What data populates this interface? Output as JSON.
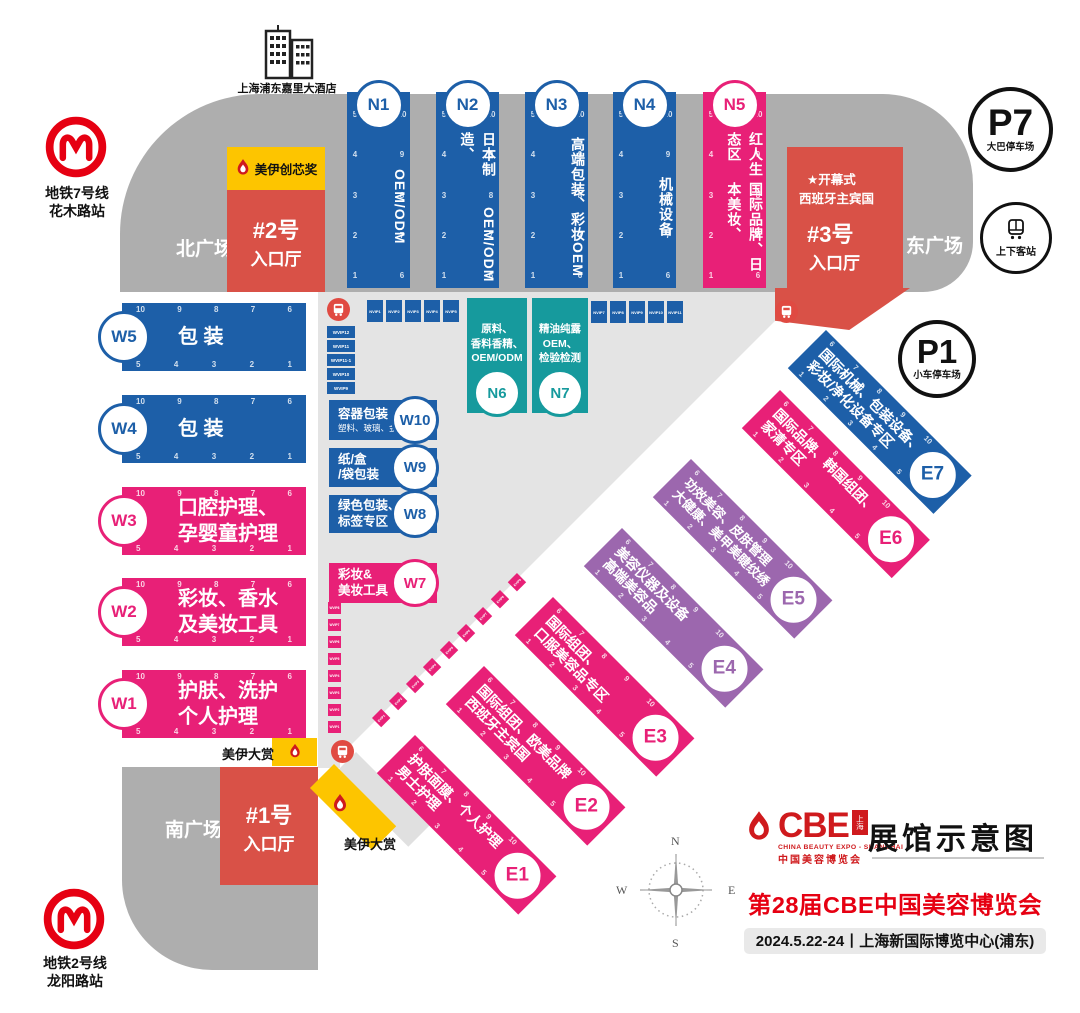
{
  "hotel": {
    "name": "上海浦东嘉里大酒店"
  },
  "metro7": {
    "line": "地铁7号线",
    "station": "花木路站"
  },
  "metro2": {
    "line": "地铁2号线",
    "station": "龙阳路站"
  },
  "plazas": {
    "north": "北广场",
    "east": "东广场",
    "south": "南广场"
  },
  "parking": {
    "p7": {
      "id": "P7",
      "label": "大巴停车场"
    },
    "p1": {
      "id": "P1",
      "label": "小车停车场"
    },
    "pickup": {
      "label": "上下客站"
    }
  },
  "entrances": {
    "no2": {
      "id": "#2号",
      "hall": "入口厅"
    },
    "no3": {
      "id": "#3号",
      "hall": "入口厅",
      "note1": "★开幕式",
      "note2": "西班牙主宾国"
    },
    "no1": {
      "id": "#1号",
      "hall": "入口厅"
    }
  },
  "awards": {
    "chuangxin": "美伊创芯奖",
    "dashang_top": "美伊大赏",
    "dashang_bottom": "美伊大赏"
  },
  "halls": {
    "n": [
      {
        "id": "N1",
        "lines": [
          "OEM/ODM"
        ]
      },
      {
        "id": "N2",
        "lines": [
          "日本制造、",
          "OEM/ODM"
        ]
      },
      {
        "id": "N3",
        "lines": [
          "高端包装、",
          "彩妆OEM"
        ]
      },
      {
        "id": "N4",
        "lines": [
          "机械设备"
        ]
      },
      {
        "id": "N5",
        "lines": [
          "红人生态区",
          "国际品牌、日本美妆、"
        ]
      }
    ],
    "w": [
      {
        "id": "W5",
        "lines": [
          "包 装"
        ]
      },
      {
        "id": "W4",
        "lines": [
          "包 装"
        ]
      },
      {
        "id": "W3",
        "lines": [
          "口腔护理、",
          "孕婴童护理"
        ]
      },
      {
        "id": "W2",
        "lines": [
          "彩妆、香水",
          "及美妆工具"
        ]
      },
      {
        "id": "W1",
        "lines": [
          "护肤、洗护",
          "个人护理"
        ]
      }
    ],
    "w_boxes": [
      {
        "id": "W10",
        "title": "容器包装",
        "sub": "塑料、玻璃、金属"
      },
      {
        "id": "W9",
        "lines": [
          "纸/盒",
          "/袋包装"
        ]
      },
      {
        "id": "W8",
        "lines": [
          "绿色包装、",
          "标签专区"
        ]
      },
      {
        "id": "W7",
        "lines": [
          "彩妆&",
          "美妆工具"
        ]
      }
    ],
    "n_boxes": [
      {
        "id": "N6",
        "lines": [
          "原料、",
          "香料香精、",
          "OEM/ODM"
        ]
      },
      {
        "id": "N7",
        "lines": [
          "精油纯露",
          "OEM、",
          "检验检测"
        ]
      }
    ],
    "e": [
      {
        "id": "E1",
        "lines": [
          "护肤面膜、个人护理",
          "男士护理"
        ]
      },
      {
        "id": "E2",
        "lines": [
          "国际组团、欧美品牌",
          "西班牙主宾国"
        ]
      },
      {
        "id": "E3",
        "lines": [
          "国际组团、",
          "口服美容品专区"
        ]
      },
      {
        "id": "E4",
        "lines": [
          "美容仪器及设备",
          "高端美容品"
        ]
      },
      {
        "id": "E5",
        "lines": [
          "功效美容、皮肤管理",
          "大健康、美甲美睫纹绣"
        ]
      },
      {
        "id": "E6",
        "lines": [
          "国际品牌、韩国组团、",
          "家清专区"
        ]
      },
      {
        "id": "E7",
        "lines": [
          "国际机械、包装设备、",
          "彩妆/净化设备专区"
        ]
      }
    ]
  },
  "nums": {
    "n_left": [
      "5",
      "4",
      "3",
      "2",
      "1"
    ],
    "n_right": [
      "10",
      "9",
      "8",
      "7",
      "6"
    ],
    "w_top": [
      "10",
      "9",
      "8",
      "7",
      "6"
    ],
    "w_bottom": [
      "5",
      "4",
      "3",
      "2",
      "1"
    ],
    "e_top": [
      "6",
      "7",
      "8",
      "9",
      "10"
    ],
    "e_bottom": [
      "1",
      "2",
      "3",
      "4",
      "5"
    ]
  },
  "vip": {
    "nvip_a": [
      "NVIP1",
      "NVIP2",
      "NVIP3",
      "NVIP4",
      "NVIP5"
    ],
    "nvip_b": [
      "NVIP7",
      "NVIP8",
      "NVIP9",
      "NVIP10",
      "NVIP11"
    ],
    "wvip_upper": [
      "WVIP12",
      "WVIP11",
      "WVIP11-1",
      "WVIP10",
      "WVIP9"
    ],
    "wvip_lower": [
      "WVIP8",
      "WVIP7",
      "WVIP6",
      "WVIP5",
      "WVIP4",
      "WVIP3",
      "WVIP2",
      "WVIP1"
    ],
    "evip": [
      "EVIP1",
      "EVIP2",
      "EVIP3",
      "EVIP4",
      "EVIP5",
      "EVIP6",
      "EVIP7",
      "EVIP8",
      "EVIP9"
    ]
  },
  "compass": {
    "n": "N",
    "w": "W",
    "e": "E",
    "s": "S"
  },
  "title_block": {
    "logo_word": "CBE",
    "logo_badge": "上海",
    "logo_sub_en": "CHINA BEAUTY EXPO - SHANGHAI",
    "logo_sub_cn": "中国美容博览会",
    "map_title": "展馆示意图",
    "expo_title": "第28届CBE中国美容博览会",
    "date_venue": "2024.5.22-24丨上海新国际博览中心(浦东)"
  },
  "colors": {
    "blue": "#1d5fa8",
    "pink": "#e82077",
    "purple": "#9c67ae",
    "teal": "#169a9d",
    "entrance_red": "#d95147",
    "brand_red": "#e60012",
    "yellow": "#fdc500",
    "gray_band": "#aeaeae"
  }
}
